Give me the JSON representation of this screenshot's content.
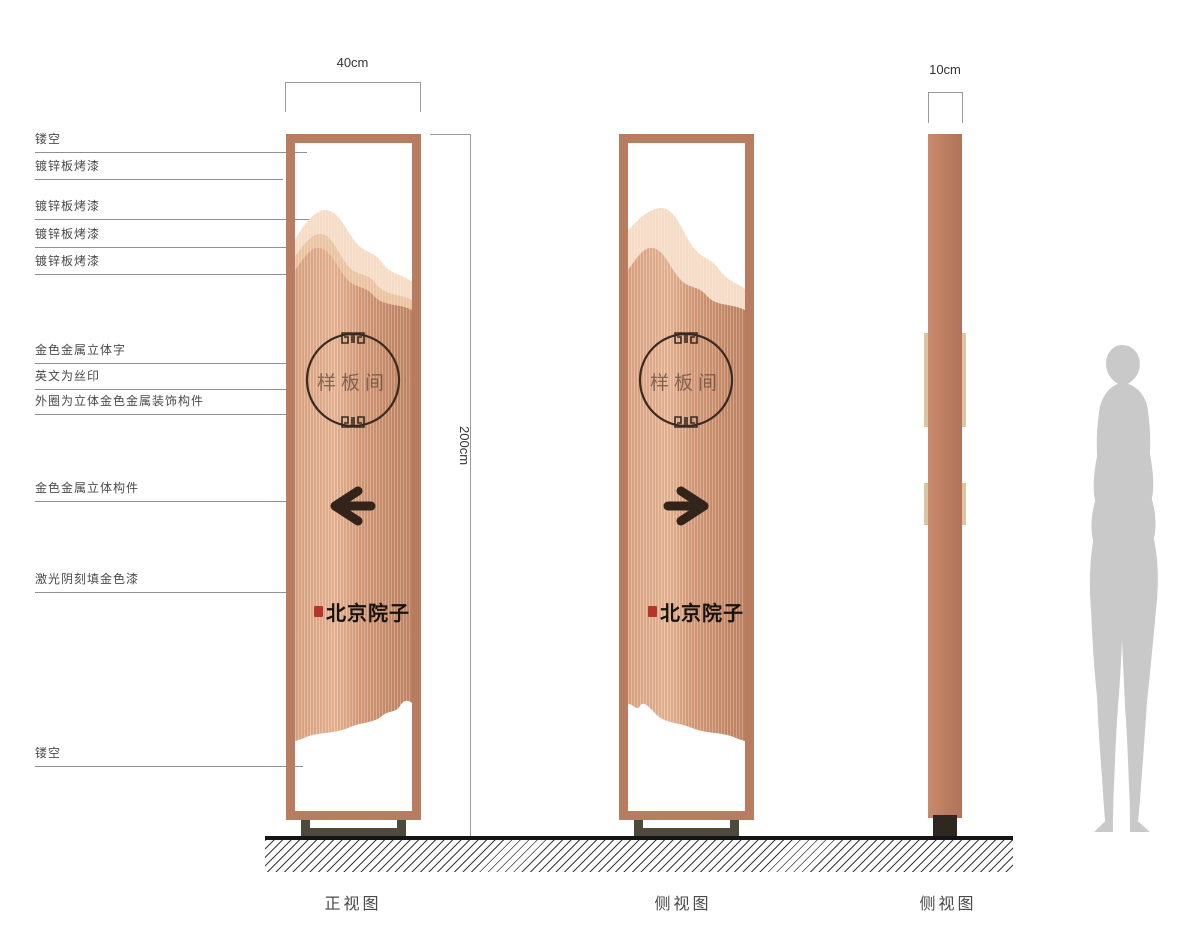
{
  "callouts": [
    {
      "label": "镂空"
    },
    {
      "label": "镀锌板烤漆"
    },
    {
      "label": "镀锌板烤漆"
    },
    {
      "label": "镀锌板烤漆"
    },
    {
      "label": "镀锌板烤漆"
    },
    {
      "label": "金色金属立体字"
    },
    {
      "label": "英文为丝印"
    },
    {
      "label": "外圈为立体金色金属装饰构件"
    },
    {
      "label": "金色金属立体构件"
    },
    {
      "label": "激光阴刻填金色漆"
    },
    {
      "label": "镂空"
    }
  ],
  "dimensions": {
    "front_width": "40cm",
    "height": "200cm",
    "side_width": "10cm"
  },
  "views": [
    {
      "label": "正视图"
    },
    {
      "label": "侧视图"
    },
    {
      "label": "侧视图"
    }
  ],
  "sign": {
    "room_name": "样板间",
    "brand": "北京院子"
  },
  "icons": {
    "front_arrow": "arrow-left",
    "back_arrow": "arrow-right",
    "ring_ornament": "greek-key-meander",
    "seal": "red-calligraphy-seal"
  },
  "colors": {
    "frame_copper": "#b87d61",
    "panel_back_mountain": "#f6dfc9",
    "panel_mid_mountain": "#eec7a6",
    "panel_body": "#d9a181",
    "arrow_dark": "#33241b",
    "seal_red": "#b5352a",
    "base_olive": "#4d4a3b",
    "silhouette_gray": "#c9c9c9"
  }
}
